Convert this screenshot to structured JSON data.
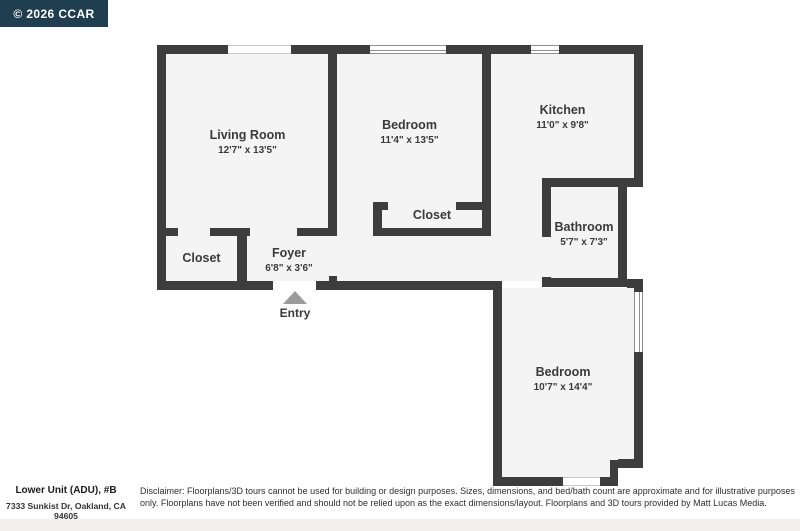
{
  "badge": {
    "text": "© 2026 CCAR"
  },
  "rooms": [
    {
      "id": "living-room",
      "name": "Living Room",
      "dims": "12'7\" x 13'5\""
    },
    {
      "id": "bedroom-top",
      "name": "Bedroom",
      "dims": "11'4\" x 13'5\""
    },
    {
      "id": "kitchen",
      "name": "Kitchen",
      "dims": "11'0\" x 9'8\""
    },
    {
      "id": "closet-bedroom",
      "name": "Closet",
      "dims": ""
    },
    {
      "id": "bathroom",
      "name": "Bathroom",
      "dims": "5'7\" x 7'3\""
    },
    {
      "id": "closet-foyer",
      "name": "Closet",
      "dims": ""
    },
    {
      "id": "foyer",
      "name": "Foyer",
      "dims": "6'8\" x 3'6\""
    },
    {
      "id": "bedroom-bottom",
      "name": "Bedroom",
      "dims": "10'7\" x 14'4\""
    }
  ],
  "entry": {
    "label": "Entry"
  },
  "footer": {
    "unit_title": "Lower Unit (ADU), #B",
    "address": "7333 Sunkist Dr, Oakland, CA 94605",
    "disclaimer": "Disclaimer: Floorplans/3D tours cannot be used for building or design purposes. Sizes, dimensions, and bed/bath count are approximate and for illustrative purposes only. Floorplans have not been verified and should not be relied upon as the exact dimensions/layout. Floorplans and 3D tours provided by Matt Lucas Media."
  },
  "colors": {
    "wall": "#3d3d3d",
    "floor": "#f4f4f4",
    "badge_bg": "#1f3e4f",
    "entry_arrow": "#9b9b9b",
    "text": "#3a3a3a"
  }
}
